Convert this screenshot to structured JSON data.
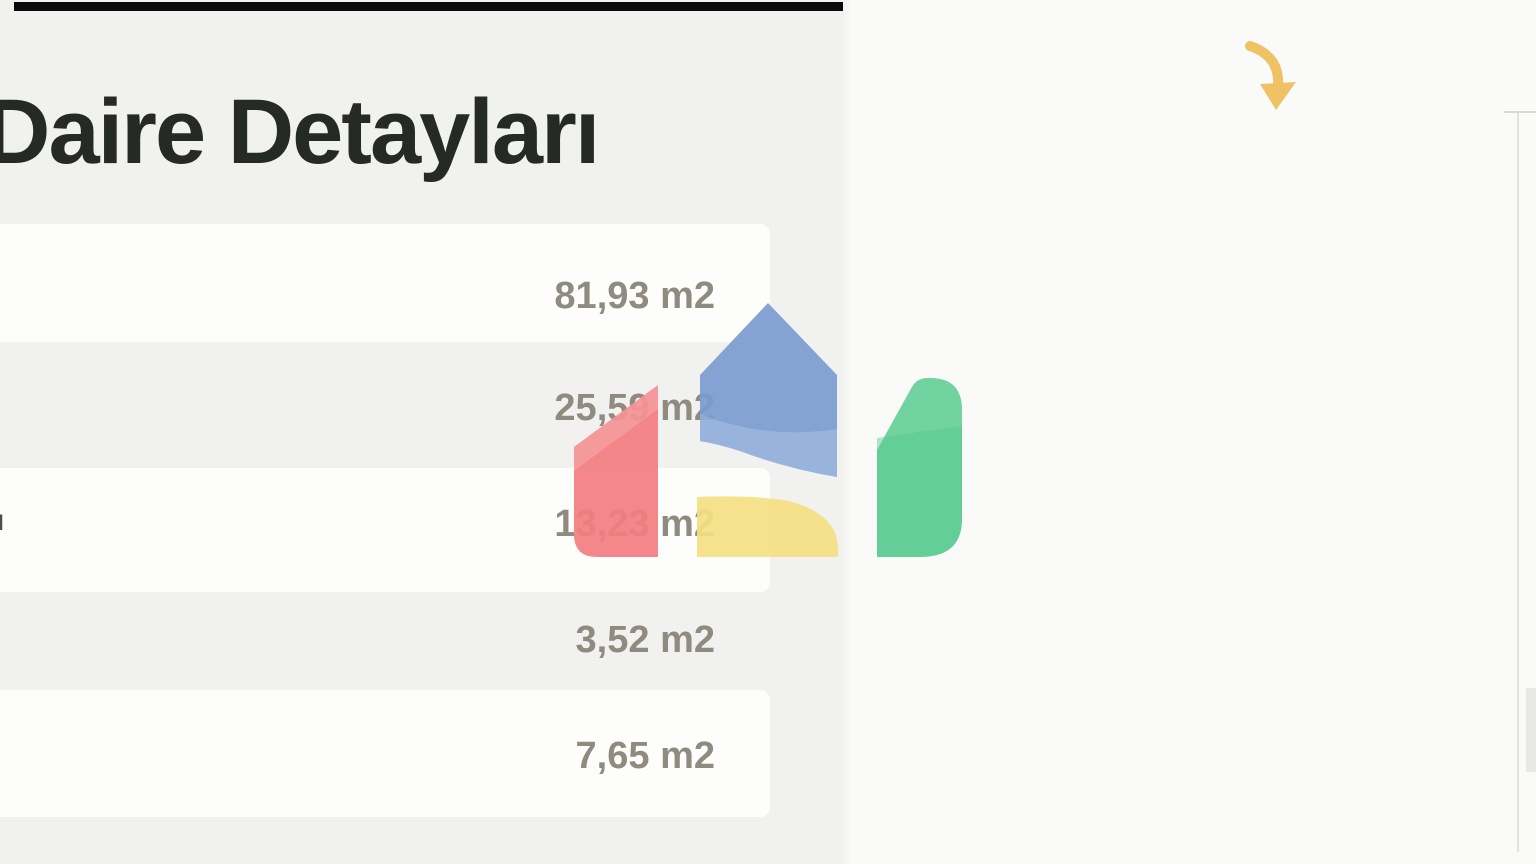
{
  "header": {
    "title": "Daire Detayları"
  },
  "details": {
    "unit_suffix": "m2",
    "rows": [
      {
        "value": "81,93 m2"
      },
      {
        "value": "25,59 m2"
      },
      {
        "label_fragment": "ı",
        "value": "13,23 m2"
      },
      {
        "value": "3,52 m2"
      },
      {
        "value": "7,65 m2"
      }
    ]
  },
  "watermark": {
    "icon": "brand-house-logo-icon",
    "colors": {
      "blue": "#7b9cd0",
      "red": "#f37d80",
      "yellow": "#f6e084",
      "green": "#57cb90"
    }
  },
  "floorplan": {
    "icon": "apartment-floor-plan-image",
    "wall_color": "#9c9c97",
    "entrance_arrow_color": "#efc263",
    "stove_color": "#7c3c40"
  }
}
